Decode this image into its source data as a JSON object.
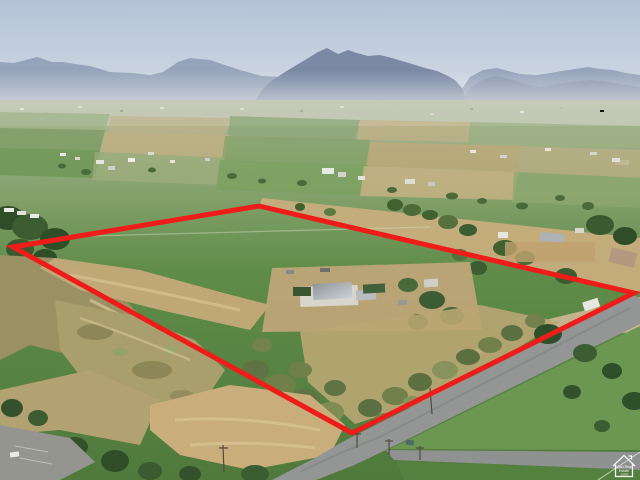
{
  "boundary": {
    "points": "13,247 259,206 634,293 352,433",
    "color": "#ee1d1a",
    "stroke_width": "5"
  },
  "watermark": {
    "lines": [
      "Utah Real",
      "Estate",
      ".com"
    ],
    "color": "#ffffff"
  },
  "palette": {
    "sky_top": "#b3c2d7",
    "sky_bottom": "#e2e6ea",
    "mountain_far": "#94a1b8",
    "mountain_near": "#7b89a4",
    "pasture_green": "#5a8744",
    "field_tan": "#c8ae7d",
    "pond_olive": "#9a9162",
    "road_gray": "#939695",
    "dirt_tan": "#c9ae7c",
    "tree_dark": "#3d5a31"
  }
}
